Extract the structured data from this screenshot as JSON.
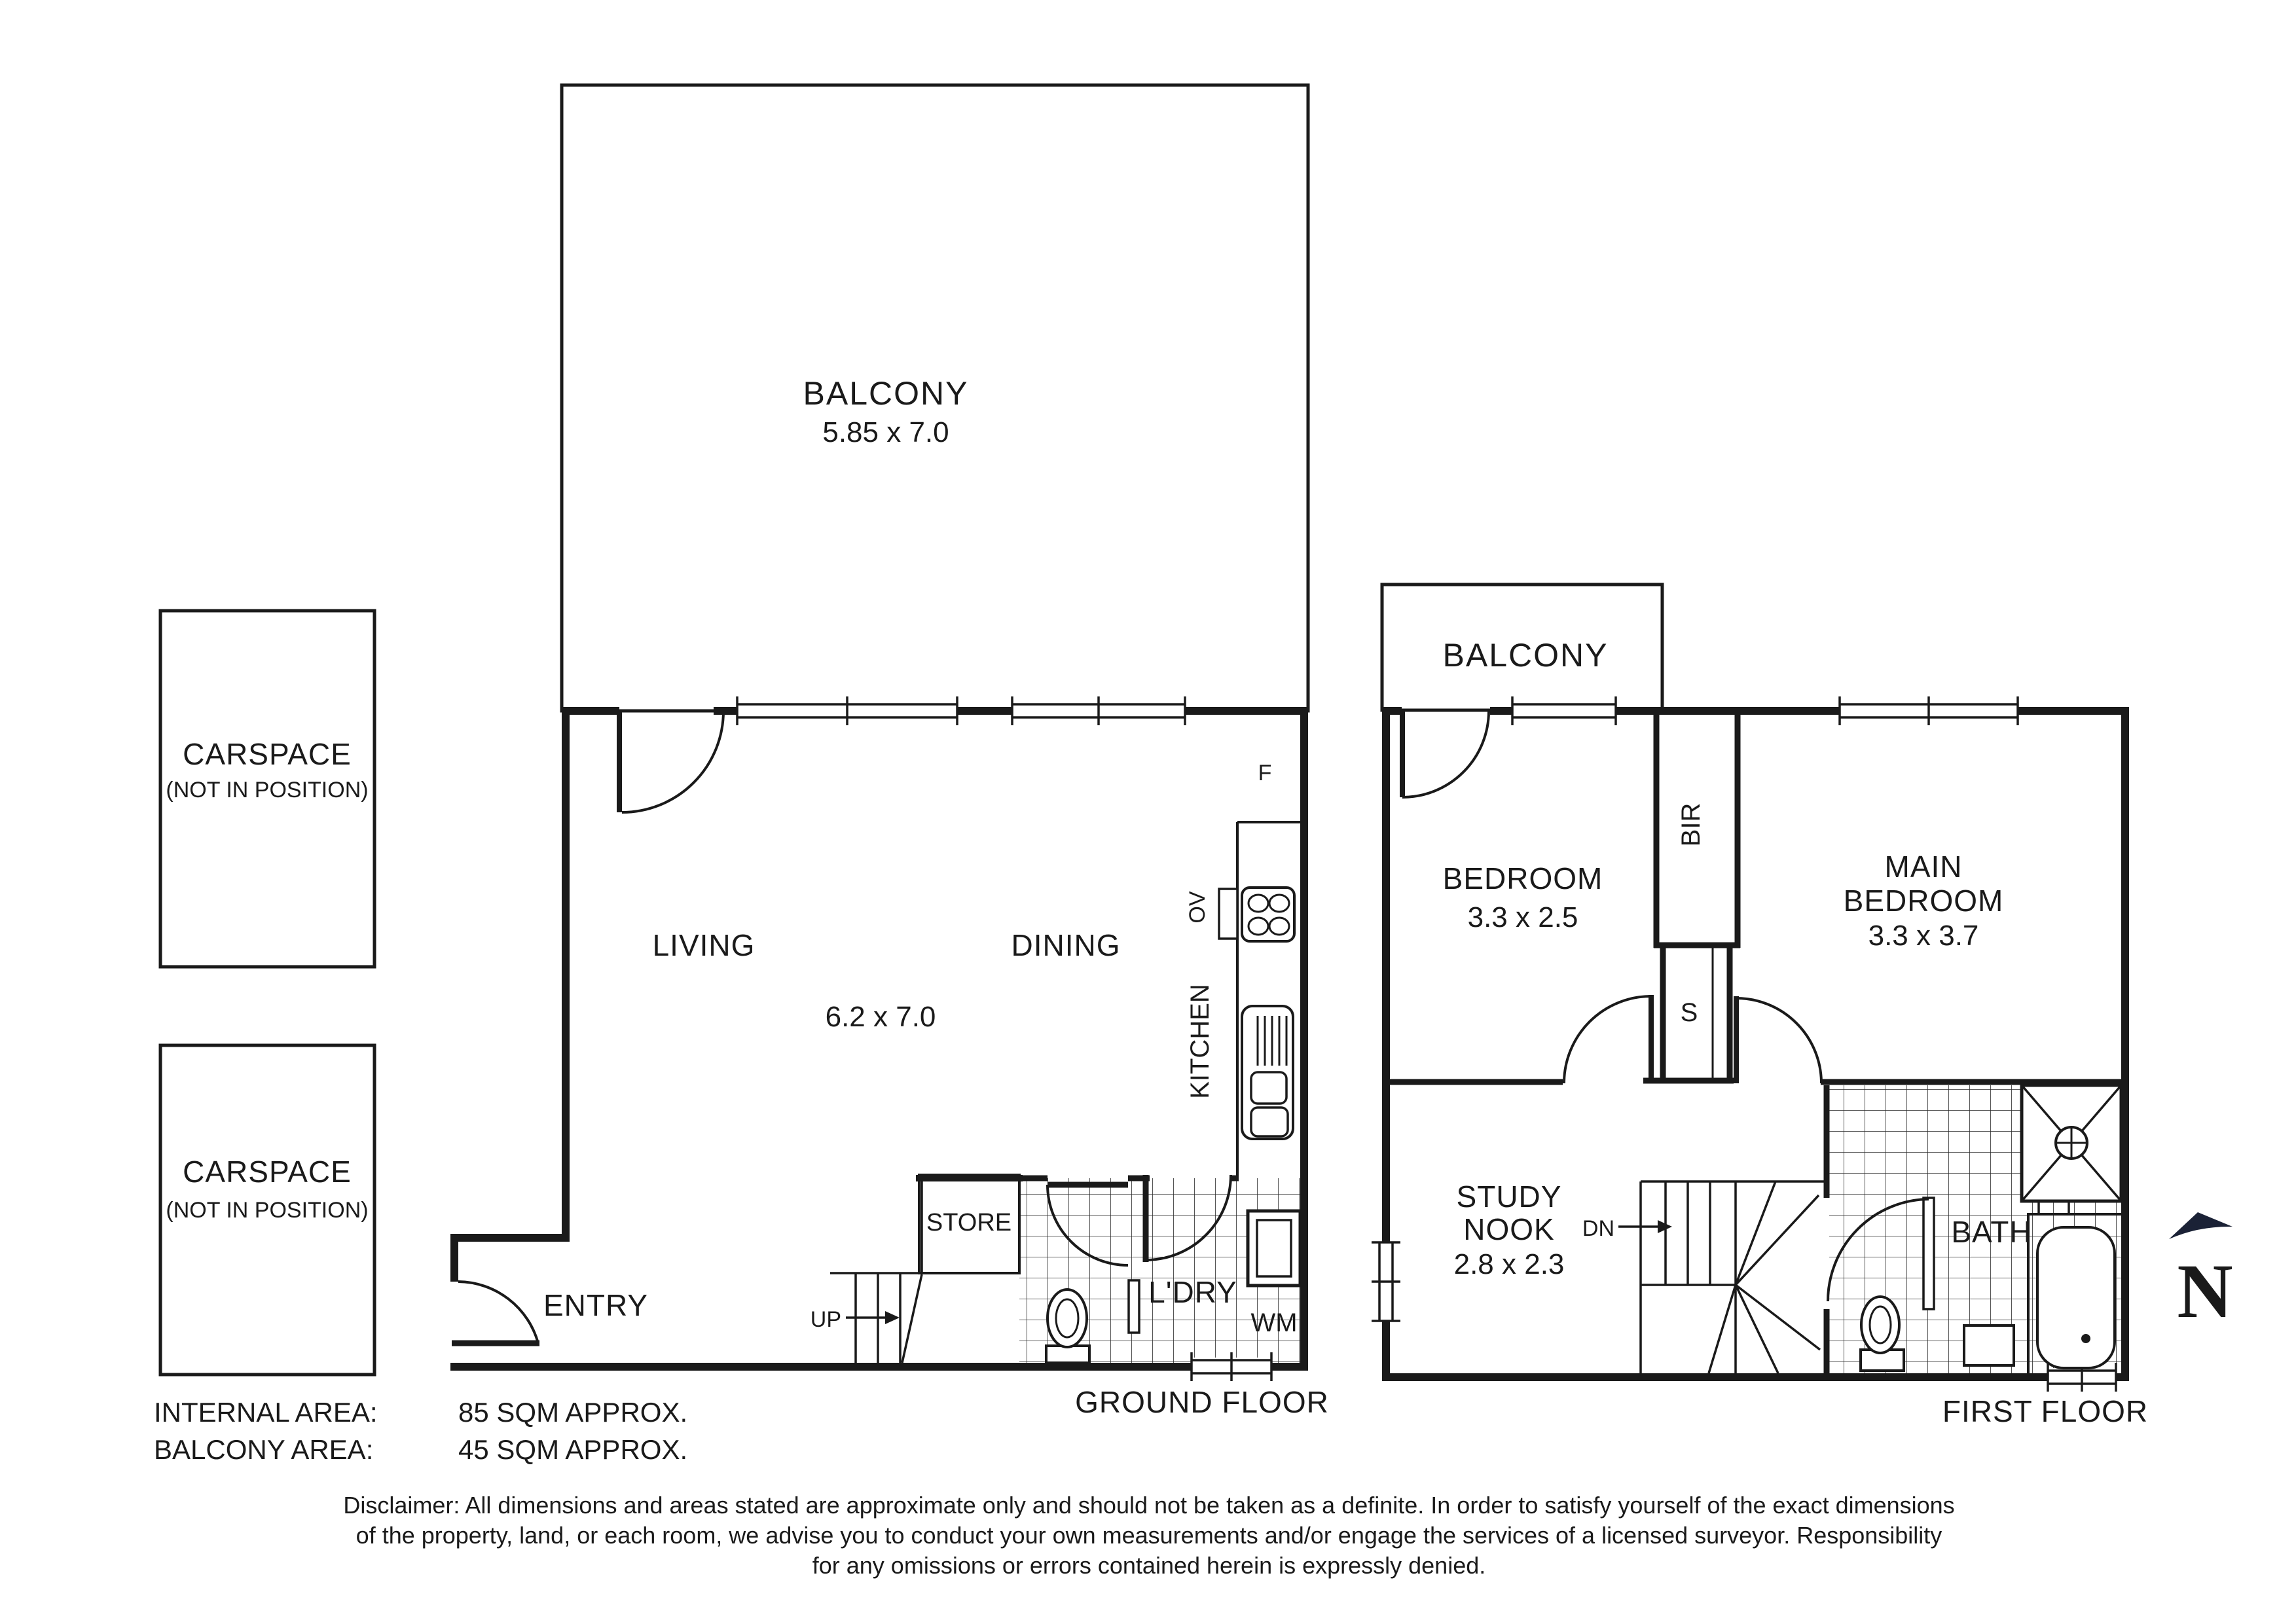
{
  "colors": {
    "ink": "#1a1a1a",
    "navy": "#1b2236",
    "white": "#ffffff"
  },
  "ground_floor": {
    "balcony_label": "BALCONY",
    "balcony_dims": "5.85 x 7.0",
    "living": "LIVING",
    "dining": "DINING",
    "living_dining_dims": "6.2 x 7.0",
    "kitchen": "KITCHEN",
    "oven": "OV",
    "fridge": "F",
    "store": "STORE",
    "laundry": "L'DRY",
    "washing_machine": "WM",
    "entry": "ENTRY",
    "up": "UP",
    "floor_label": "GROUND FLOOR"
  },
  "first_floor": {
    "balcony_label": "BALCONY",
    "bedroom": "BEDROOM",
    "bedroom_dims": "3.3 x 2.5",
    "main_bedroom_line1": "MAIN",
    "main_bedroom_line2": "BEDROOM",
    "main_bedroom_dims": "3.3 x 3.7",
    "bir": "BIR",
    "s_cupboard": "S",
    "study_line1": "STUDY",
    "study_line2": "NOOK",
    "study_dims": "2.8 x 2.3",
    "dn": "DN",
    "bath": "BATH",
    "floor_label": "FIRST FLOOR"
  },
  "carspaces": [
    {
      "label": "CARSPACE",
      "sub": "(NOT IN POSITION)"
    },
    {
      "label": "CARSPACE",
      "sub": "(NOT IN POSITION)"
    }
  ],
  "compass": {
    "letter": "N"
  },
  "areas": {
    "internal_label": "INTERNAL AREA:",
    "internal_value": "85 SQM APPROX.",
    "balcony_label": "BALCONY AREA:",
    "balcony_value": "45 SQM APPROX."
  },
  "disclaimer": {
    "line1": "Disclaimer: All dimensions and areas stated are approximate only and should not be taken as a definite. In order to satisfy yourself of the exact dimensions",
    "line2": "of the property, land, or each room, we advise you to conduct your own measurements and/or engage the services of a licensed surveyor. Responsibility",
    "line3": "for any omissions or errors contained herein is expressly denied."
  }
}
